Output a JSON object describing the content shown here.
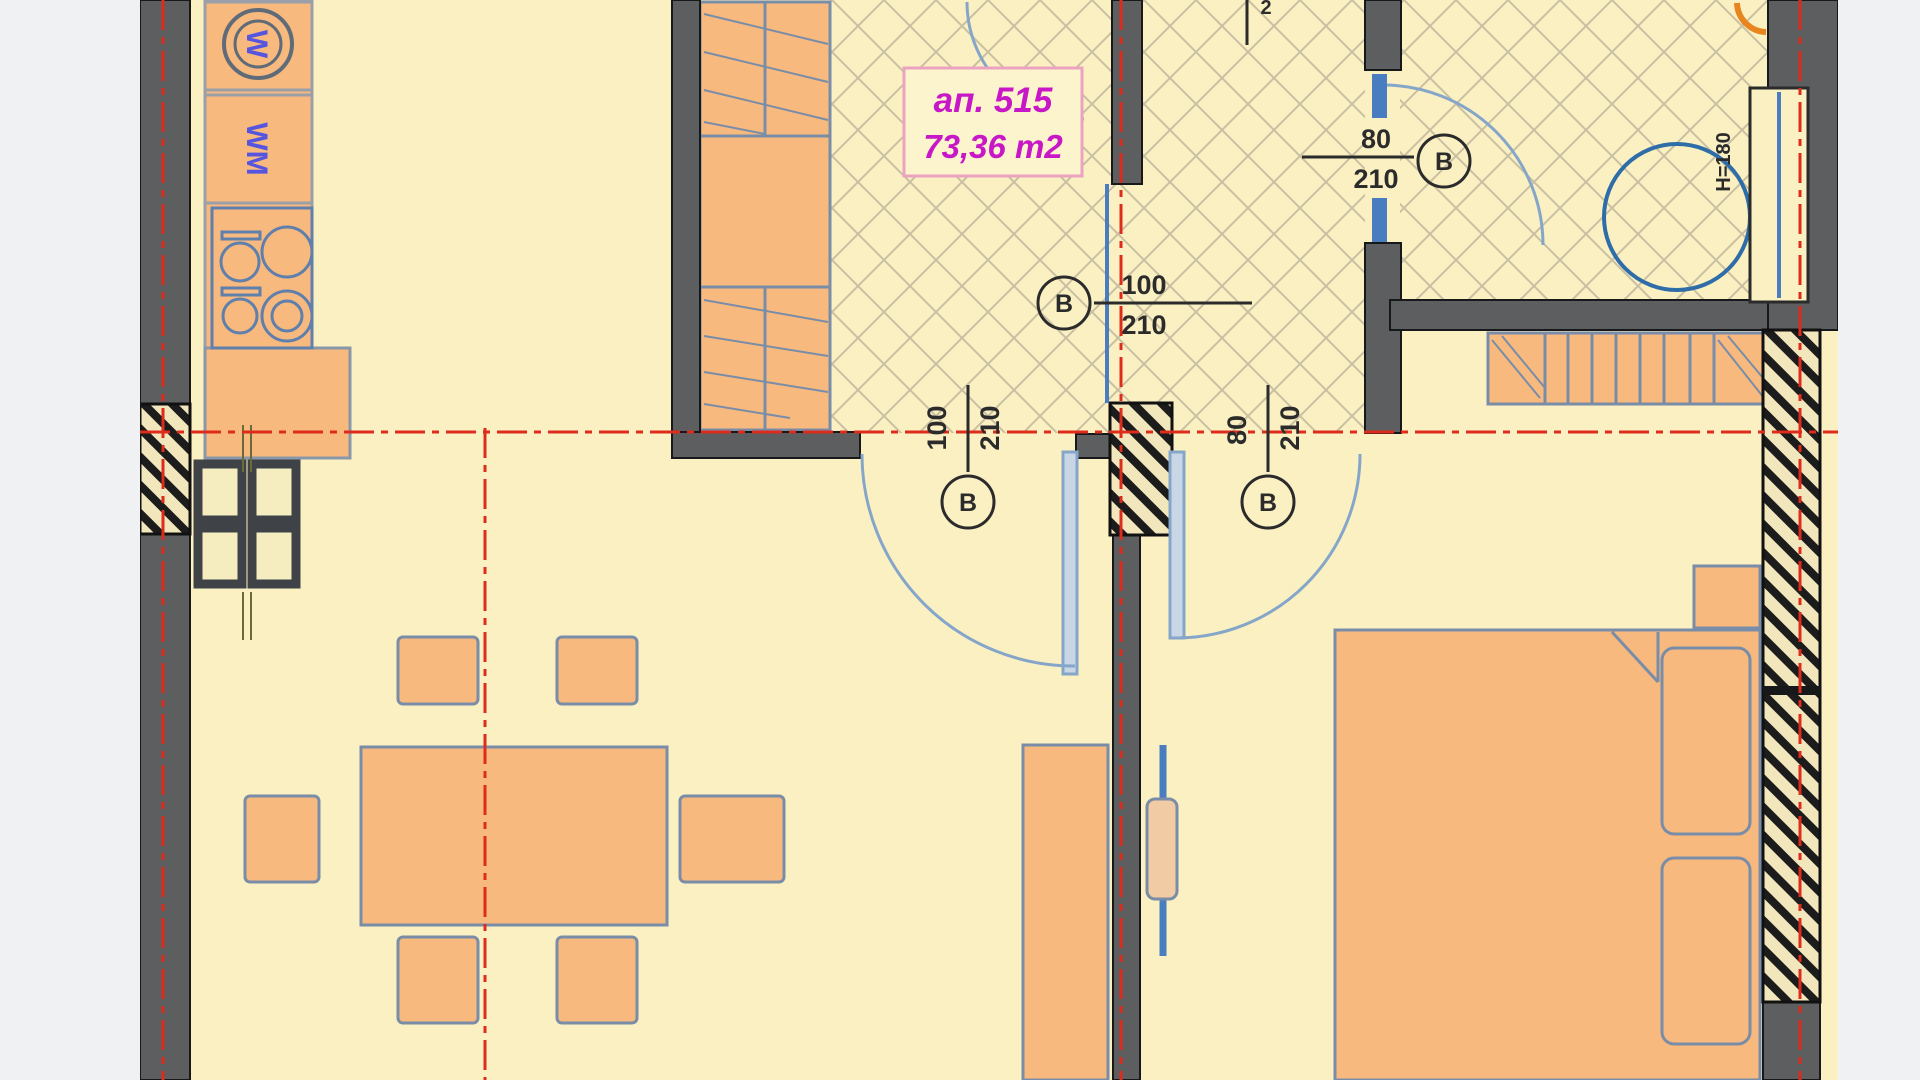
{
  "plan": {
    "apartment_label": {
      "line1": "ап. 515",
      "line2": "73,36 m2"
    },
    "door_labels": [
      {
        "id": "bath-door",
        "width": "80",
        "height": "210",
        "letter": "B"
      },
      {
        "id": "corridor-door",
        "width": "100",
        "height": "210",
        "letter": "B"
      },
      {
        "id": "living-door",
        "width": "100",
        "height": "210",
        "letter": "B"
      },
      {
        "id": "bedroom-door",
        "width": "80",
        "height": "210",
        "letter": "B"
      }
    ],
    "annotations": {
      "window_height_note": "H=180",
      "top_partial_dim": "2"
    },
    "appliances": {
      "washing_machine_letter": "W",
      "laundry_label": "WM"
    },
    "colors": {
      "background": "#f0f1f2",
      "floor_cream": "#faf0c2",
      "furniture_orange": "#f8b97e",
      "wall_gray": "#5c5e60",
      "axis_red": "#dd2b1c",
      "fixture_blue": "#4a7cc0",
      "outline_slate": "#7a8da8",
      "label_magenta": "#c717c7",
      "hatch_tan": "#c9c0a2"
    }
  }
}
